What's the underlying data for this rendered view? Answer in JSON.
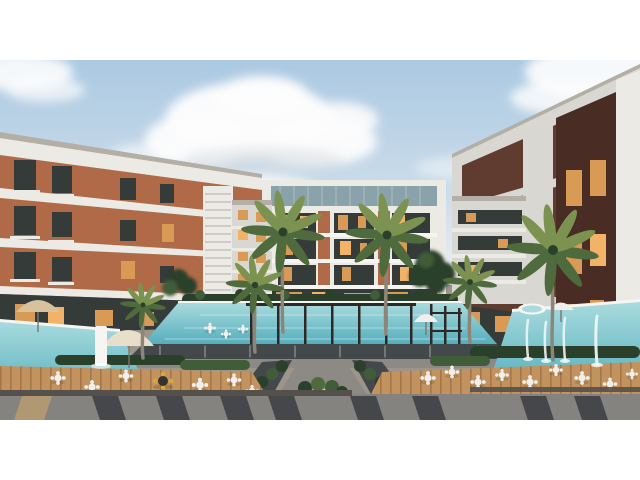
{
  "image": {
    "type": "architectural-render",
    "description": "Dusk aerial render of a modern residential apartment compound: white and brick apartment wings around a landscaped courtyard with a central swimming pool, pergola, palm trees, wooden dining decks with white bistro furniture, umbrellas, fountain jets and a striped paved promenade in the foreground."
  },
  "scene": {
    "elements": [
      "sky",
      "clouds",
      "left-apartment-wing",
      "center-apartment-building",
      "right-apartment-wing",
      "courtyard-plaza",
      "main-pool",
      "pergola",
      "side-pools",
      "wooden-decks",
      "dining-sets",
      "umbrellas",
      "palm-trees",
      "hedges",
      "fountain-jets",
      "striped-pavement"
    ]
  },
  "palette": {
    "sky-top": "#abc9e2",
    "sky-mid": "#cdddea",
    "sky-low": "#e8eef2",
    "cloud": "#fdfdfd",
    "cloud-shadow": "#d8dde2",
    "white-bright": "#f6f5f1",
    "white-warm": "#eceae4",
    "white-cool": "#d9d7d1",
    "gray-fascia": "#b3aea6",
    "brick-left": "#b06a48",
    "brick-left-dark": "#95573a",
    "brick-right": "#5f3b30",
    "brick-right-dark": "#492d25",
    "glass-dark": "#343b39",
    "glass-teal": "#8aa3aa",
    "window-warm": "#d89a54",
    "window-bright": "#f2b368",
    "green-dark": "#2a402a",
    "green-mid": "#415c39",
    "palm-green": "#4f6b3d",
    "palm-light": "#7b9250",
    "trunk": "#8d8678",
    "pool-light": "#a8dbde",
    "pool-deep": "#55aebc",
    "wood": "#c2935f",
    "wood-dark": "#a3774a",
    "plaza": "#9c958b",
    "concrete": "#8d8984",
    "channel": "#43484b",
    "wall-dark": "#54514c",
    "pavement": "#858380",
    "stripe": "#3a3d41",
    "stripe-tan": "#b09873",
    "furniture-white": "#f1efeb",
    "umbrella-cream": "#e8dfca",
    "umbrella-tan": "#d7c29c",
    "chair-yellow": "#d7a63d",
    "pergola": "#2c2926",
    "water-white": "#edf5f6",
    "pole": "#7a766f"
  }
}
